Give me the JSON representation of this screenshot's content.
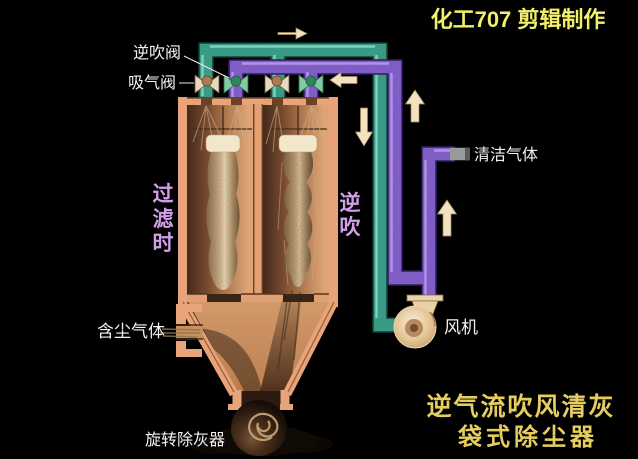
{
  "window": {
    "width": 638,
    "height": 459,
    "background": "#000000"
  },
  "title": {
    "text": "化工707 剪辑制作"
  },
  "caption": {
    "line1": "逆气流吹风清灰",
    "line2": "袋式除尘器"
  },
  "labels": {
    "reverse_blow_valve": "逆吹阀",
    "suction_valve": "吸气阀",
    "clean_gas": "清洁气体",
    "dusty_gas": "含尘气体",
    "fan": "风机",
    "rotary_ash_remover": "旋转除灰器",
    "filtering_chars": [
      "过",
      "滤",
      "时"
    ],
    "reverse_blow_chars": [
      "逆",
      "吹"
    ]
  },
  "colors": {
    "title_yellow": "#f2ef6b",
    "caption_gold": "#e5cd5f",
    "label_white": "#f2f2f2",
    "label_purple": "#d29fe8",
    "pipe_teal": "#2f9e8a",
    "pipe_purple": "#7e5ad0",
    "pipe_gray_end": "#9a9a9a",
    "vessel_wall": "#e8a478",
    "arrow_cream": "#f2e2c0",
    "valve_tan": "#e9d9bf",
    "valve_green": "#82caa4",
    "fan_body": "#ecd7ae"
  }
}
